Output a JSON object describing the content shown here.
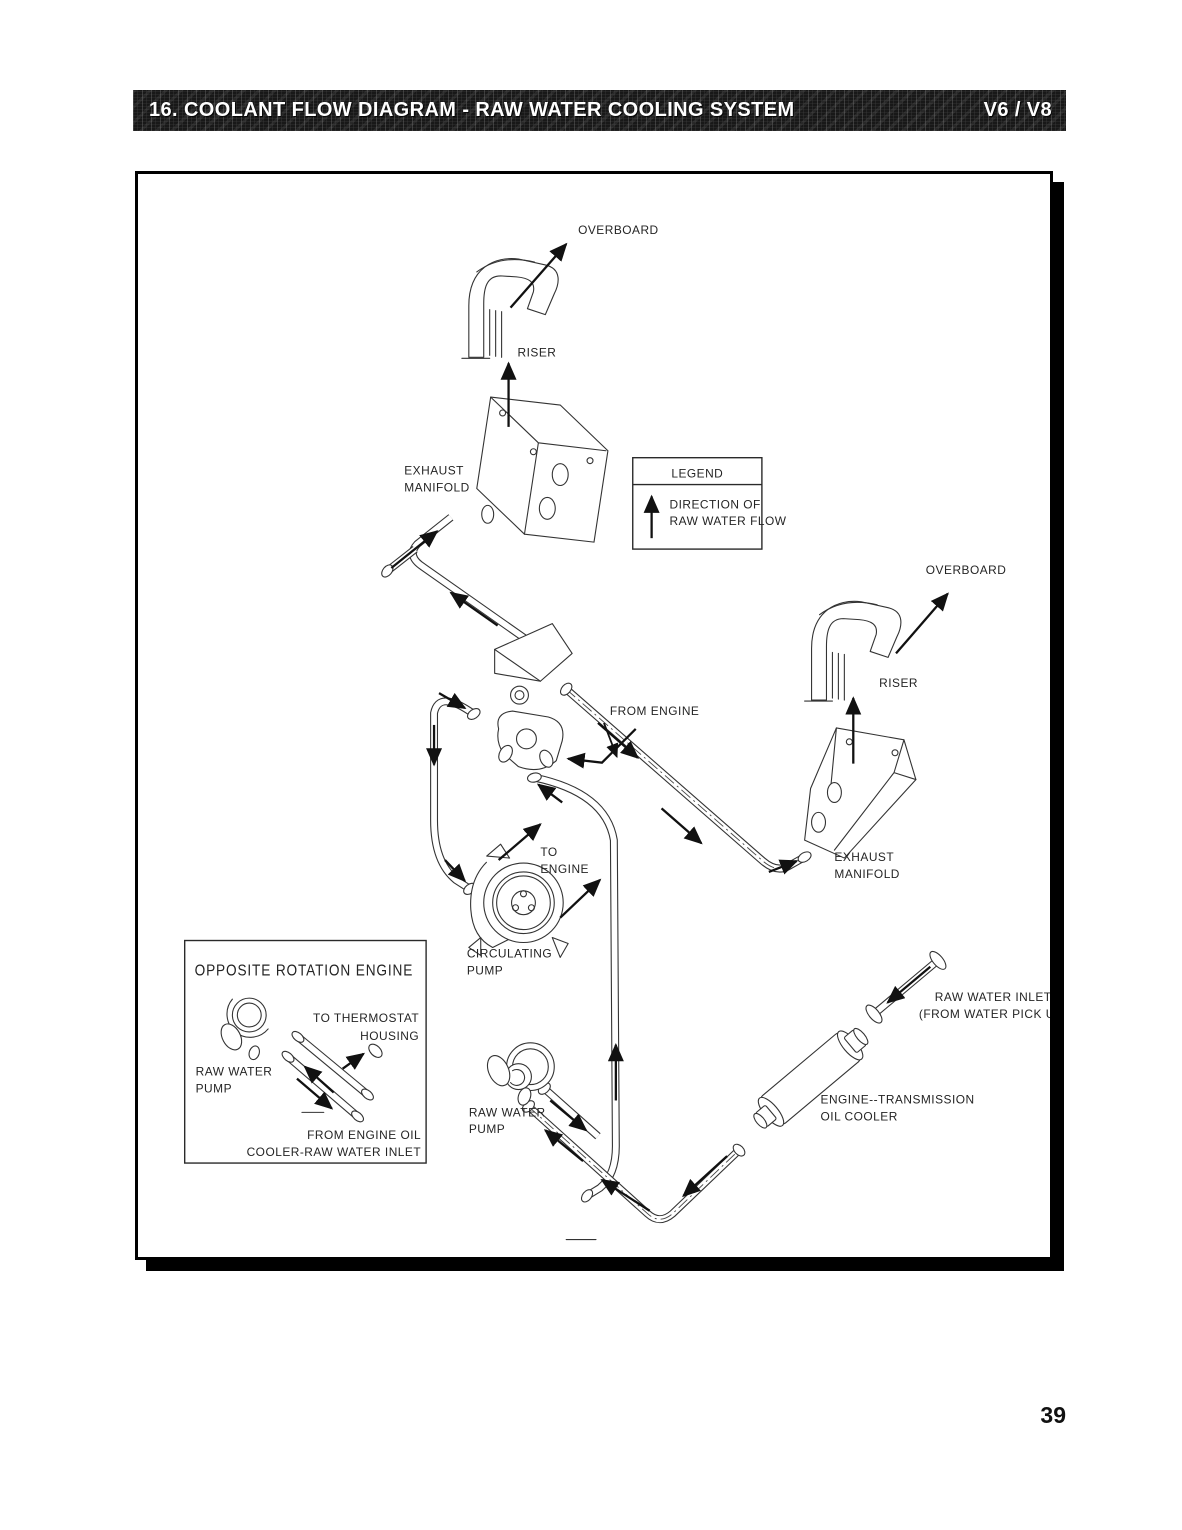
{
  "header": {
    "title": "16.  COOLANT FLOW DIAGRAM - RAW WATER COOLING SYSTEM",
    "variant": "V6 / V8"
  },
  "footer": {
    "page_number": "39"
  },
  "legend": {
    "title": "LEGEND",
    "entry": [
      "DIRECTION OF",
      "RAW WATER FLOW"
    ]
  },
  "diagram": {
    "labels": {
      "overboard_left": "OVERBOARD",
      "riser_left": "RISER",
      "exhaust_manifold_left": [
        "EXHAUST",
        "MANIFOLD"
      ],
      "overboard_right": "OVERBOARD",
      "riser_right": "RISER",
      "exhaust_manifold_right": [
        "EXHAUST",
        "MANIFOLD"
      ],
      "from_engine": "FROM ENGINE",
      "to_engine": [
        "TO",
        "ENGINE"
      ],
      "circulating_pump": [
        "CIRCULATING",
        "PUMP"
      ],
      "raw_water_pump": [
        "RAW WATER",
        "PUMP"
      ],
      "raw_water_inlet": [
        "RAW WATER INLET",
        "(FROM WATER PICK UP)"
      ],
      "oil_cooler": [
        "ENGINE--TRANSMISSION",
        "OIL COOLER"
      ]
    },
    "inset": {
      "title": "OPPOSITE ROTATION ENGINE",
      "labels": {
        "to_thermostat": [
          "TO THERMOSTAT",
          "HOUSING"
        ],
        "raw_water_pump": [
          "RAW WATER",
          "PUMP"
        ],
        "from_engine_oil": [
          "FROM ENGINE OIL",
          "COOLER-RAW WATER INLET"
        ]
      }
    }
  }
}
